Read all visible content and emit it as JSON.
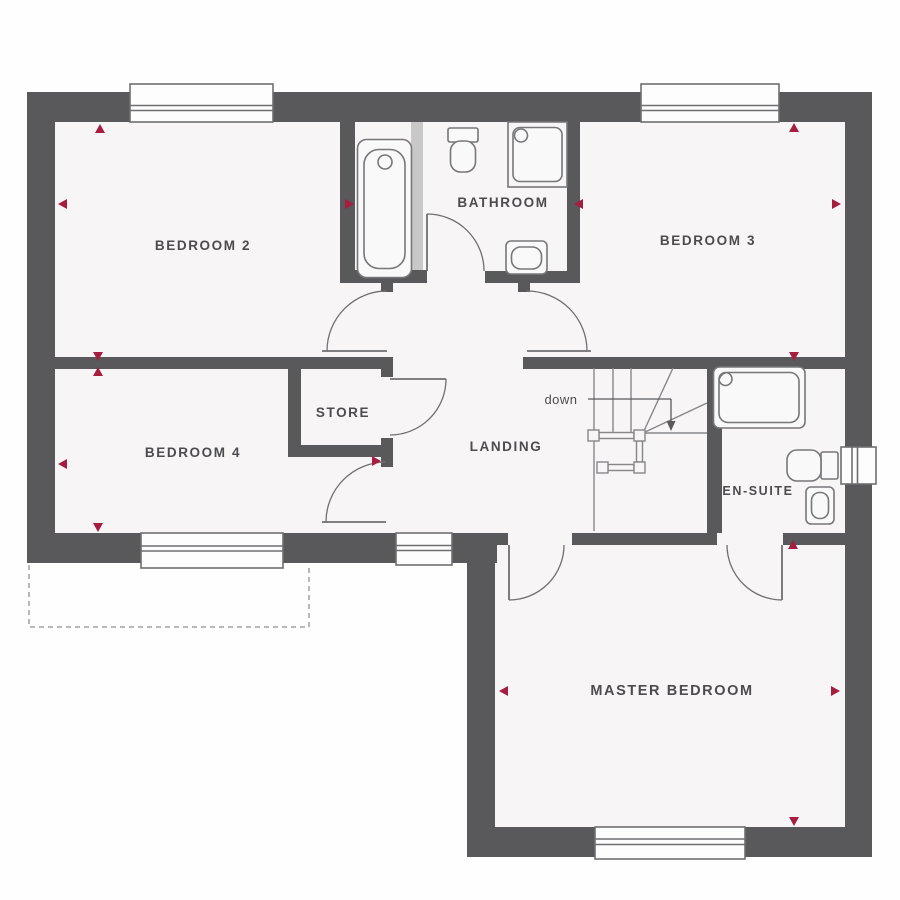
{
  "title": "First floor plan",
  "rooms": [
    {
      "id": "bedroom2",
      "label": "BEDROOM 2"
    },
    {
      "id": "bathroom",
      "label": "BATHROOM"
    },
    {
      "id": "bedroom3",
      "label": "BEDROOM 3"
    },
    {
      "id": "bedroom4",
      "label": "BEDROOM 4"
    },
    {
      "id": "store",
      "label": "STORE"
    },
    {
      "id": "landing",
      "label": "LANDING"
    },
    {
      "id": "ensuite",
      "label": "EN-SUITE"
    },
    {
      "id": "master",
      "label": "MASTER BEDROOM"
    }
  ],
  "stairs": {
    "down_label": "down"
  },
  "fixtures": [
    "bath-tub",
    "toilet-bathroom",
    "shower-bathroom",
    "basin-bathroom",
    "shower-ensuite",
    "toilet-ensuite",
    "basin-ensuite"
  ],
  "windows": [
    "bedroom2-top",
    "bedroom3-top",
    "bedroom4-bottom",
    "landing-bottom",
    "master-bottom",
    "ensuite-right"
  ],
  "colors": {
    "wall": "#59595b",
    "floor": "#f7f5f6",
    "bg": "#fefefe",
    "line": "#6f6f71",
    "lightline": "#87878a",
    "nichewall": "#c8c8c8",
    "label": "#4c4c4e",
    "accent": "#a51e40",
    "dash": "#a0a0a0"
  }
}
